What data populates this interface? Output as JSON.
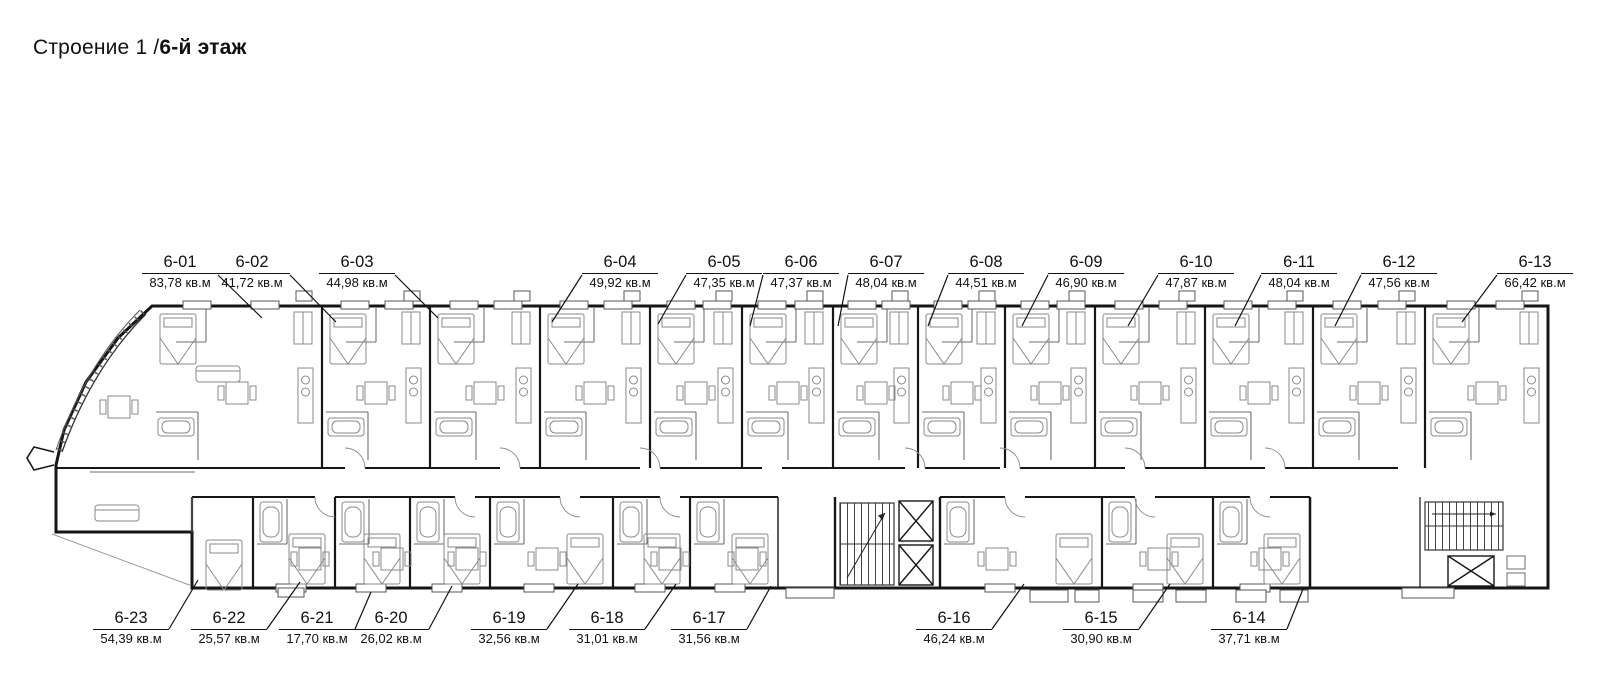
{
  "page": {
    "title_prefix": "Строение 1 /",
    "title_floor": "6-й этаж"
  },
  "area_unit": "кв.м",
  "units": [
    {
      "id": "6-01",
      "area": "83,78 кв.м",
      "row": "top"
    },
    {
      "id": "6-02",
      "area": "41,72 кв.м",
      "row": "top"
    },
    {
      "id": "6-03",
      "area": "44,98 кв.м",
      "row": "top"
    },
    {
      "id": "6-04",
      "area": "49,92 кв.м",
      "row": "top"
    },
    {
      "id": "6-05",
      "area": "47,35 кв.м",
      "row": "top"
    },
    {
      "id": "6-06",
      "area": "47,37 кв.м",
      "row": "top"
    },
    {
      "id": "6-07",
      "area": "48,04 кв.м",
      "row": "top"
    },
    {
      "id": "6-08",
      "area": "44,51 кв.м",
      "row": "top"
    },
    {
      "id": "6-09",
      "area": "46,90 кв.м",
      "row": "top"
    },
    {
      "id": "6-10",
      "area": "47,87 кв.м",
      "row": "top"
    },
    {
      "id": "6-11",
      "area": "48,04 кв.м",
      "row": "top"
    },
    {
      "id": "6-12",
      "area": "47,56 кв.м",
      "row": "top"
    },
    {
      "id": "6-13",
      "area": "66,42 кв.м",
      "row": "top"
    },
    {
      "id": "6-23",
      "area": "54,39 кв.м",
      "row": "bottom"
    },
    {
      "id": "6-22",
      "area": "25,57 кв.м",
      "row": "bottom"
    },
    {
      "id": "6-21",
      "area": "17,70 кв.м",
      "row": "bottom"
    },
    {
      "id": "6-20",
      "area": "26,02 кв.м",
      "row": "bottom"
    },
    {
      "id": "6-19",
      "area": "32,56 кв.м",
      "row": "bottom"
    },
    {
      "id": "6-18",
      "area": "31,01 кв.м",
      "row": "bottom"
    },
    {
      "id": "6-17",
      "area": "31,56 кв.м",
      "row": "bottom"
    },
    {
      "id": "6-16",
      "area": "46,24 кв.м",
      "row": "bottom"
    },
    {
      "id": "6-15",
      "area": "30,90 кв.м",
      "row": "bottom"
    },
    {
      "id": "6-14",
      "area": "37,71 кв.м",
      "row": "bottom"
    }
  ]
}
